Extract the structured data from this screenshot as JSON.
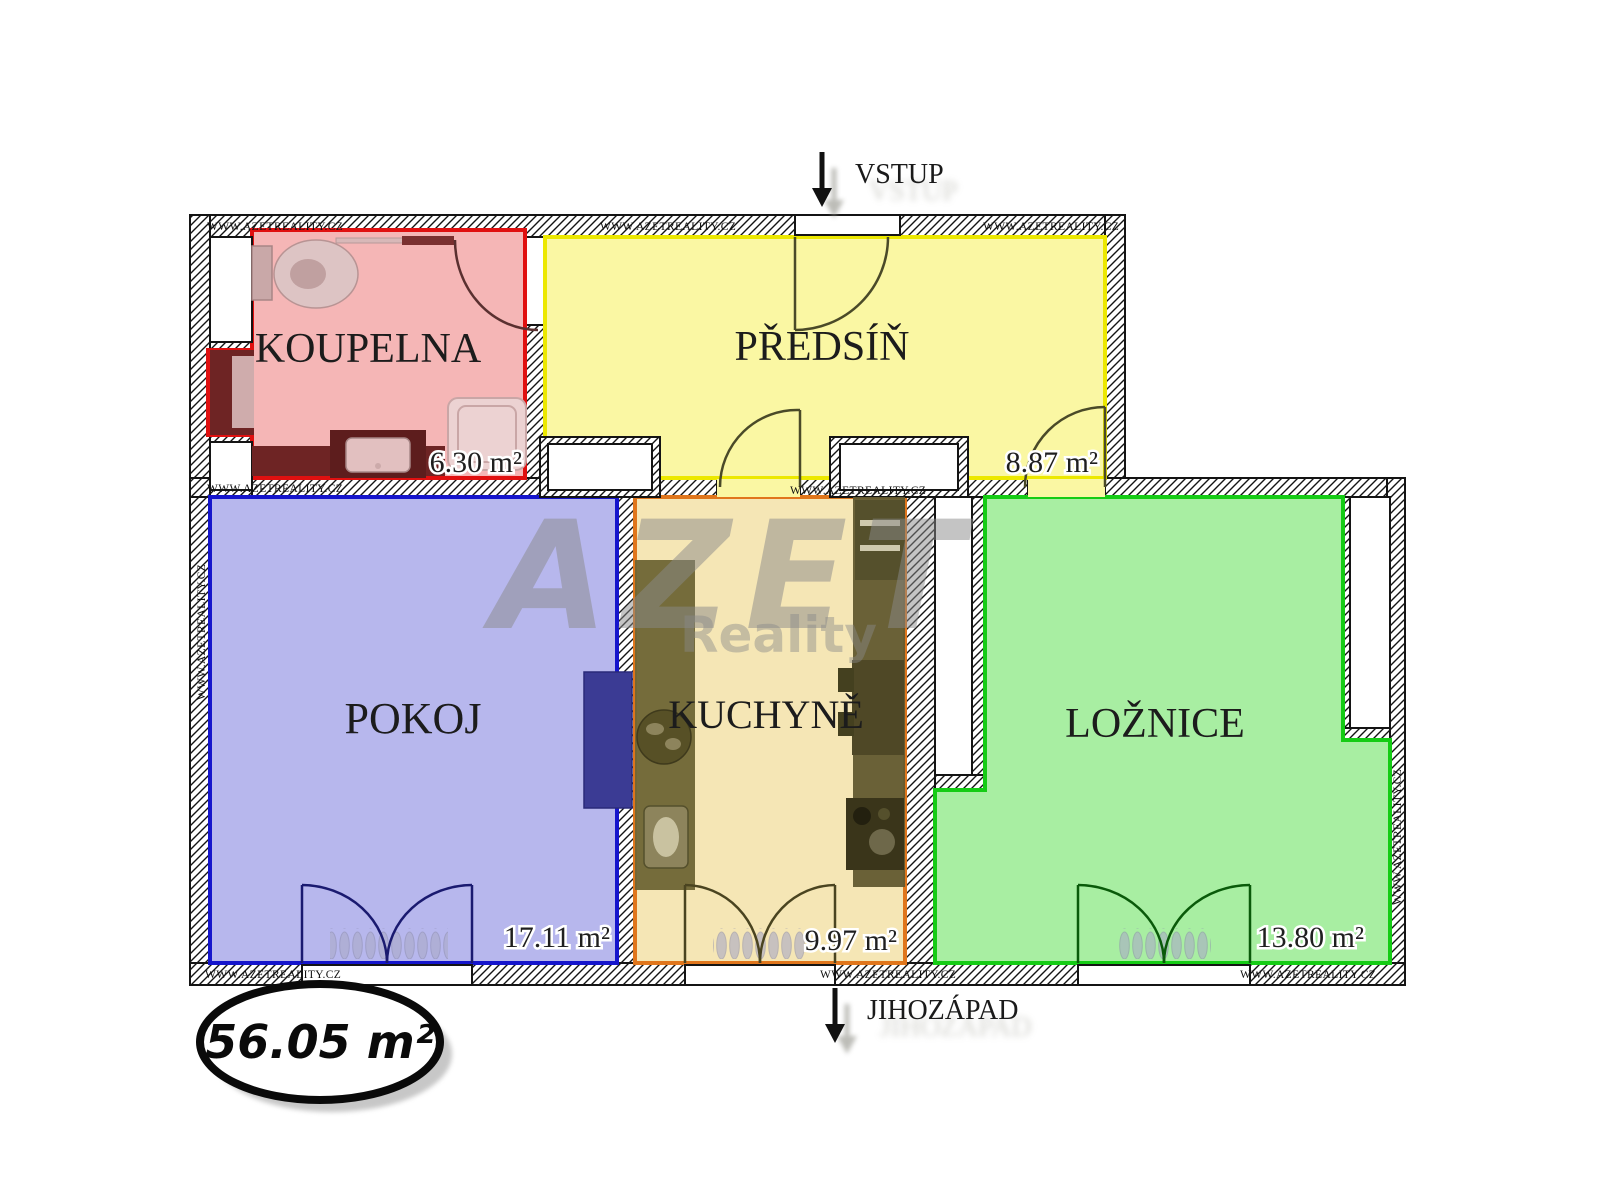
{
  "plan": {
    "total_area": "56.05 m²",
    "entrance_label": "VSTUP",
    "orientation_label": "JIHOZÁPAD",
    "rooms": [
      {
        "name": "KOUPELNA",
        "area": "6.30 m²",
        "fill": "#f5b6b6",
        "border": "#e01010",
        "area_color": "#7a6a14"
      },
      {
        "name": "PŘEDSÍŇ",
        "area": "8.87 m²",
        "fill": "#faf7a3",
        "border": "#ece800",
        "area_color": "#1f1f1f"
      },
      {
        "name": "POKOJ",
        "area": "17.11 m²",
        "fill": "#b7b7ed",
        "border": "#1515cc",
        "area_color": "#1f1f1f"
      },
      {
        "name": "KUCHYNĚ",
        "area": "9.97 m²",
        "fill": "#f5e6b5",
        "border": "#e0761c",
        "area_color": "#1f1f1f"
      },
      {
        "name": "LOŽNICE",
        "area": "13.80 m²",
        "fill": "#a8eea2",
        "border": "#15cc15",
        "area_color": "#1f1f1f"
      }
    ]
  },
  "branding": {
    "watermark_title": "AZET",
    "watermark_subtitle": "Reality",
    "watermark_color": "#8a8a8a",
    "wall_text": "WWW.AZETREALITY.CZ"
  }
}
